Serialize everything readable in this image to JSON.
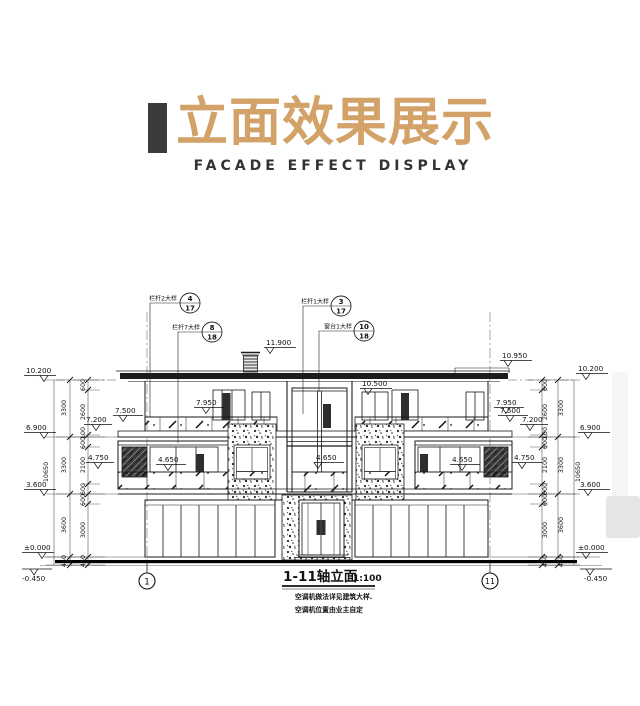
{
  "header": {
    "title": "立面效果展示",
    "subtitle": "FACADE EFFECT DISPLAY",
    "accent_color": "#d2a269",
    "bar_color": "#3b3b3b"
  },
  "drawing": {
    "title": "1-11轴立面",
    "scale": "1:100",
    "notes": {
      "line1": "空调机做法详见建筑大样.",
      "line2": "空调机位置由业主自定"
    },
    "axis": {
      "left": "1",
      "right": "11"
    },
    "callouts": {
      "c1": {
        "label": "栏杆2大样",
        "top": "4",
        "bot": "17"
      },
      "c2": {
        "label": "栏杆7大样",
        "top": "8",
        "bot": "18"
      },
      "c3": {
        "label": "栏杆1大样",
        "top": "3",
        "bot": "17"
      },
      "c4": {
        "label": "窗台1大样",
        "top": "10",
        "bot": "18"
      }
    },
    "el": {
      "l10200": "10.200",
      "l6900": "6.900",
      "l3600": "3.600",
      "lzero": "±0.000",
      "lneg": "-0.450",
      "r10200": "10.200",
      "r6900": "6.900",
      "r3600": "3.600",
      "rzero": "±0.000",
      "rneg": "-0.450",
      "chimney": "11.900",
      "roof_right": "10.950",
      "tower": "10.500",
      "l7500": "7.500",
      "l7200": "7.200",
      "l7950": "7.950",
      "r7950": "7.950",
      "r7500": "7.500",
      "r7200": "7.200",
      "l4750": "4.750",
      "l4650": "4.650",
      "c4650": "4.650",
      "r4650": "4.650",
      "r4750": "4.750"
    },
    "dim": {
      "li": [
        "600",
        "2600",
        "100",
        "600",
        "2100",
        "600",
        "600",
        "3000",
        "450"
      ],
      "lm": [
        "3300",
        "3300",
        "3600",
        "450"
      ],
      "lt": "10650",
      "ri": [
        "600",
        "2600",
        "100",
        "600",
        "2100",
        "600",
        "600",
        "3000",
        "450"
      ],
      "rm": [
        "3300",
        "3300",
        "3600",
        "450"
      ],
      "rt": "10650"
    }
  }
}
